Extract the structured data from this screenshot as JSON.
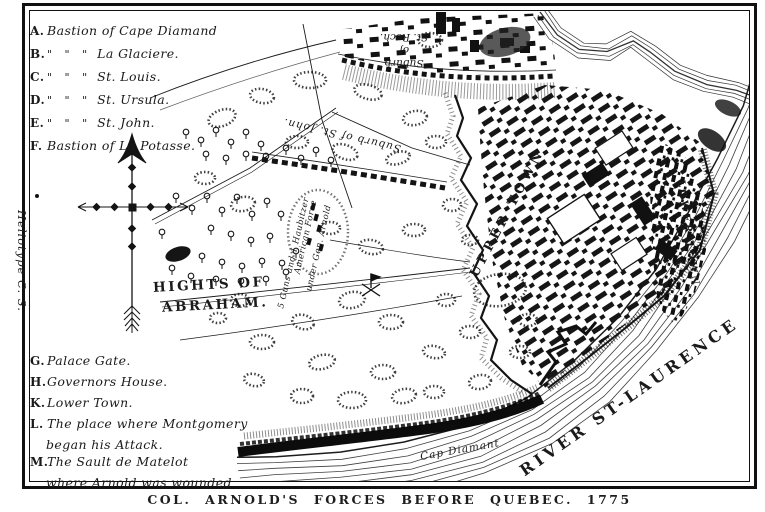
{
  "palette": {
    "ink": "#1a1a1a",
    "paper": "#ffffff"
  },
  "legend_top": {
    "items": [
      {
        "key": "A.",
        "ditto": "",
        "name": "Bastion of Cape Diamand"
      },
      {
        "key": "B.",
        "ditto": "\" \" \"",
        "name": "La Glaciere."
      },
      {
        "key": "C.",
        "ditto": "\" \" \"",
        "name": "St. Louis."
      },
      {
        "key": "D.",
        "ditto": "\" \" \"",
        "name": "St. Ursula."
      },
      {
        "key": "E.",
        "ditto": "\" \" \"",
        "name": "St. John."
      },
      {
        "key": "F.",
        "ditto": "",
        "name": "Bastion of La Potasse."
      }
    ]
  },
  "legend_bottom": {
    "items": [
      {
        "key": "G.",
        "line1": "Palace Gate.",
        "line2": ""
      },
      {
        "key": "H.",
        "line1": "Governors House.",
        "line2": ""
      },
      {
        "key": "K.",
        "line1": "Lower Town.",
        "line2": ""
      },
      {
        "key": "L.",
        "line1": "The place where Montgomery",
        "line2": "began his Attack."
      },
      {
        "key": "M.",
        "line1": "The Sault de Matelot",
        "line2": "where Arnold was wounded"
      }
    ]
  },
  "map_labels": {
    "hights_line1": "HIGHTS OF",
    "hights_line2": "ABRAHAM.",
    "upper_town": "UPPER TOWN",
    "lower_town": "LOWER TOWN",
    "suburb_st_john": "Suburb of St. John.",
    "suburb_st_roch_lines": [
      "Suburb",
      "of",
      "St. Roch."
    ],
    "river": "RIVER ST-LAURENCE",
    "cap_diamant": "Cap Diamant",
    "american_line1": "American Force",
    "american_line2": "under Gen. Arnold",
    "american_line3": "5 Guns and 1 Haubitzer"
  },
  "credit": "Heliotype C. S.",
  "caption": "COL. ARNOLD'S FORCES BEFORE QUEBEC. 1775"
}
